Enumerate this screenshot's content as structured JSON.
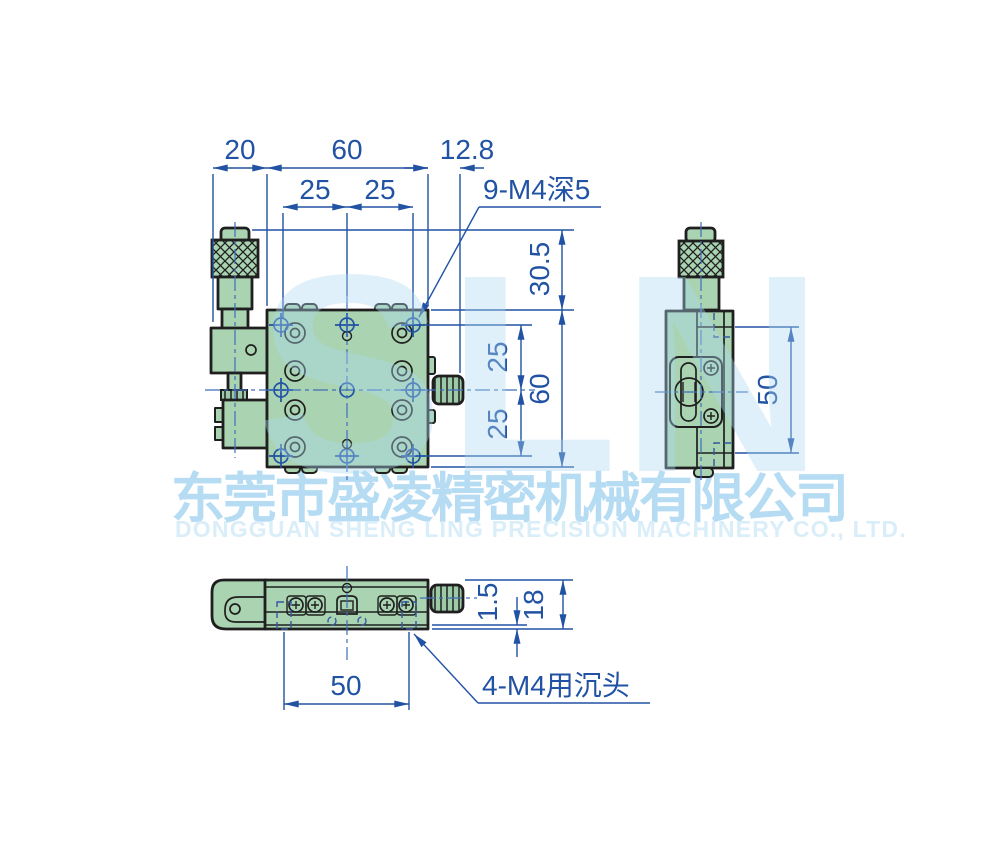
{
  "watermark": {
    "logo_text": "SLN",
    "company_cn": "东莞市盛凌精密机械有限公司",
    "company_en": "DONGGUAN SHENG LING PRECISION MACHINERY CO., LTD."
  },
  "colors": {
    "dimension_blue": "#2152a3",
    "part_green": "#a9d3b1",
    "outline_dark": "#1f1f1f",
    "centerline_blue": "#3f6fbe",
    "watermark_blue": "#b5dcf3"
  },
  "views": {
    "front": {
      "dims": {
        "micrometer_bracket_width": "20",
        "stage_width": "60",
        "knob_overhang": "12.8",
        "hole_pitch_x1": "25",
        "hole_pitch_x2": "25",
        "head_height": "30.5",
        "hole_pitch_y1": "25",
        "hole_pitch_y2": "25",
        "stage_height": "60"
      },
      "callout_tapped_holes": "9-M4深5"
    },
    "side": {
      "dims": {
        "mount_hole_span": "50"
      }
    },
    "bottom": {
      "dims": {
        "base_lip": "1.5",
        "base_thickness": "18",
        "counterbore_span": "50"
      },
      "callout_counterbore": "4-M4用沉头"
    }
  }
}
